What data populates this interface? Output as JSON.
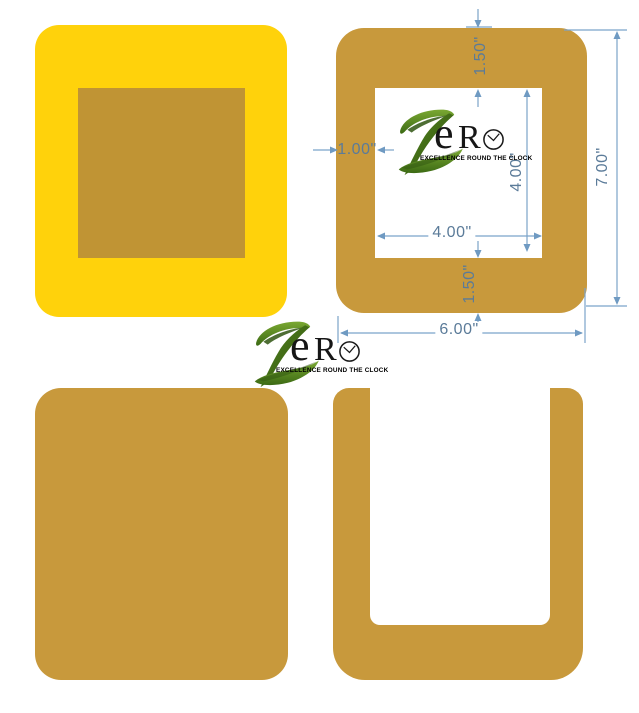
{
  "page": {
    "background": "#ffffff",
    "description": "Craft mat product dimension diagram"
  },
  "colors": {
    "yellow_mat": "#ffd20b",
    "mustard_mat": "#c8993c",
    "mustard_inset": "#c09434",
    "dimension_line": "#7ba3c9",
    "dimension_text": "#5b7b99",
    "logo_green": "#5c8f22",
    "logo_green_dark": "#2f5510",
    "logo_text": "#161616"
  },
  "logo": {
    "letter_e": "e",
    "letter_r": "R",
    "tagline": "EXCELLENCE ROUND THE CLOCK"
  },
  "dimensions": {
    "top_border": "1.50\"",
    "left_border": "1.00\"",
    "inner_height": "4.00\"",
    "inner_width": "4.00\"",
    "outer_height": "7.00\"",
    "outer_width": "6.00\"",
    "bottom_border": "1.50\""
  }
}
